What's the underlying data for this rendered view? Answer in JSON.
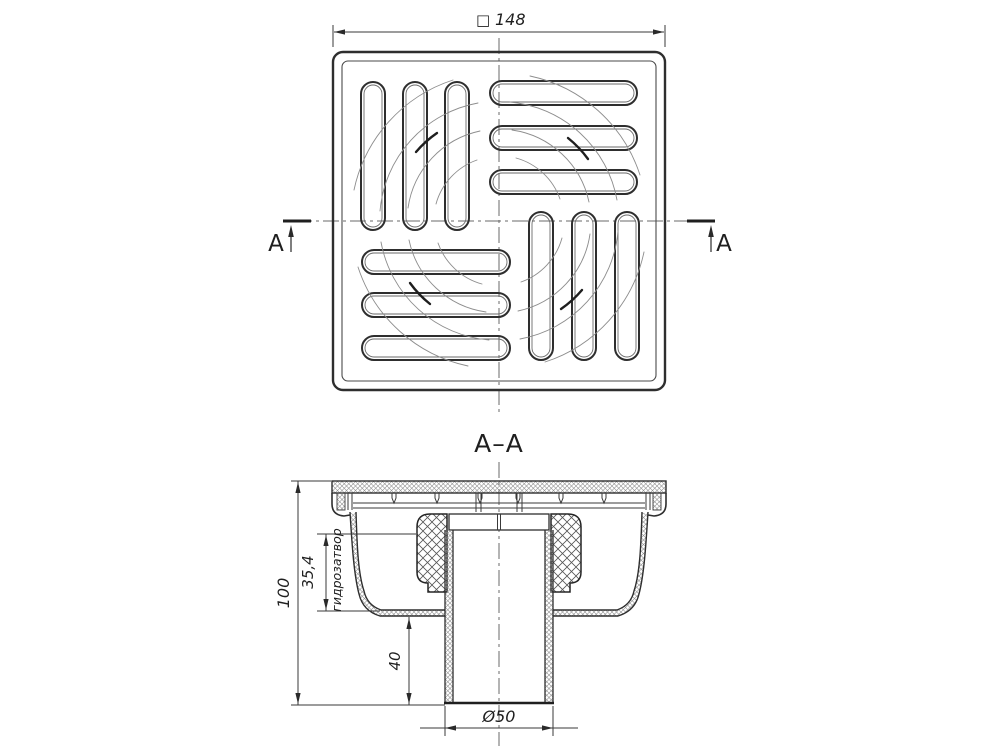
{
  "top_view": {
    "size_symbol": "□",
    "size_value": "148",
    "section_marker_left": "A",
    "section_marker_right": "A"
  },
  "section_view": {
    "title": "A–A",
    "dimensions": {
      "overall_height": "100",
      "water_seal_height": "35,4",
      "water_seal_label": "гидрозатвор",
      "outlet_length": "40",
      "outlet_diameter": "Ø50"
    }
  }
}
